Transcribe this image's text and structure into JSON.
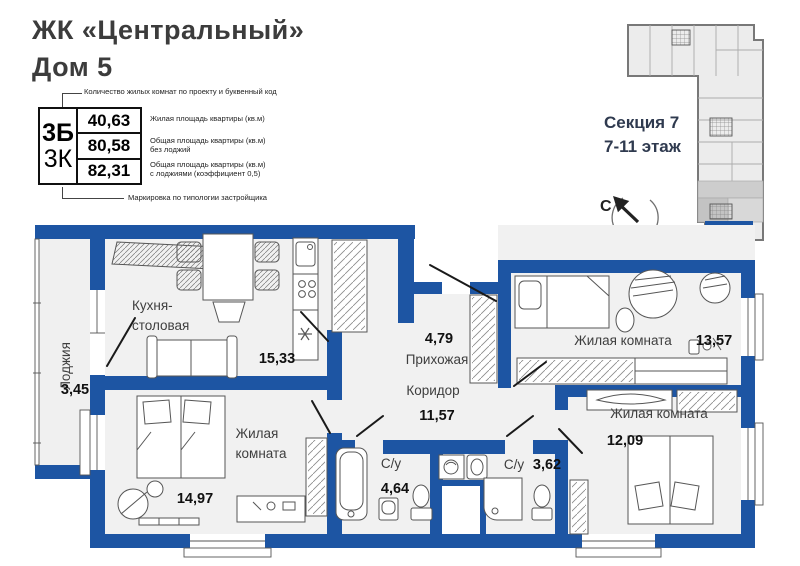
{
  "colors": {
    "wall_blue": "#1d55a3",
    "room_fill": "#f1f1f1",
    "keyplan_fill": "#ececec",
    "section_text": "#2f3a4f"
  },
  "header": {
    "title_line1": "ЖК «Центральный»",
    "title_line2": "Дом 5"
  },
  "legend": {
    "annotation_top": "Количество жилых комнат по проекту и буквенный код",
    "annotation_bottom": "Маркировка по типологии застройщика",
    "code_primary": "3Б",
    "code_secondary": "3К",
    "rows": [
      {
        "value": "40,63",
        "label": "Жилая площадь квартиры (кв.м)"
      },
      {
        "value": "80,58",
        "label": "Общая площадь квартиры (кв.м) без лоджий"
      },
      {
        "value": "82,31",
        "label": "Общая площадь квартиры (кв.м) с лоджиями (коэффициент 0,5)"
      }
    ]
  },
  "section_info": {
    "line1": "Секция 7",
    "line2": "7-11 этаж"
  },
  "compass": {
    "label": "С"
  },
  "rooms": [
    {
      "id": "loggia",
      "lines": [
        "Лоджия"
      ],
      "area": "3,45"
    },
    {
      "id": "kitchen-dining",
      "lines": [
        "Кухня-",
        "столовая"
      ],
      "area": "15,33"
    },
    {
      "id": "entry-hall",
      "lines": [
        "Прихожая"
      ],
      "area": "4,79"
    },
    {
      "id": "living-room-1",
      "lines": [
        "Жилая комната"
      ],
      "area": "13,57"
    },
    {
      "id": "corridor",
      "lines": [
        "Коридор"
      ],
      "area": "11,57"
    },
    {
      "id": "living-room-2",
      "lines": [
        "Жилая комната"
      ],
      "area": "12,09"
    },
    {
      "id": "living-room-3",
      "lines": [
        "Жилая",
        "комната"
      ],
      "area": "14,97"
    },
    {
      "id": "bathroom-1",
      "lines": [
        "С/у"
      ],
      "area": "4,64"
    },
    {
      "id": "bathroom-2",
      "lines": [
        "С/у"
      ],
      "area": "3,62"
    }
  ]
}
